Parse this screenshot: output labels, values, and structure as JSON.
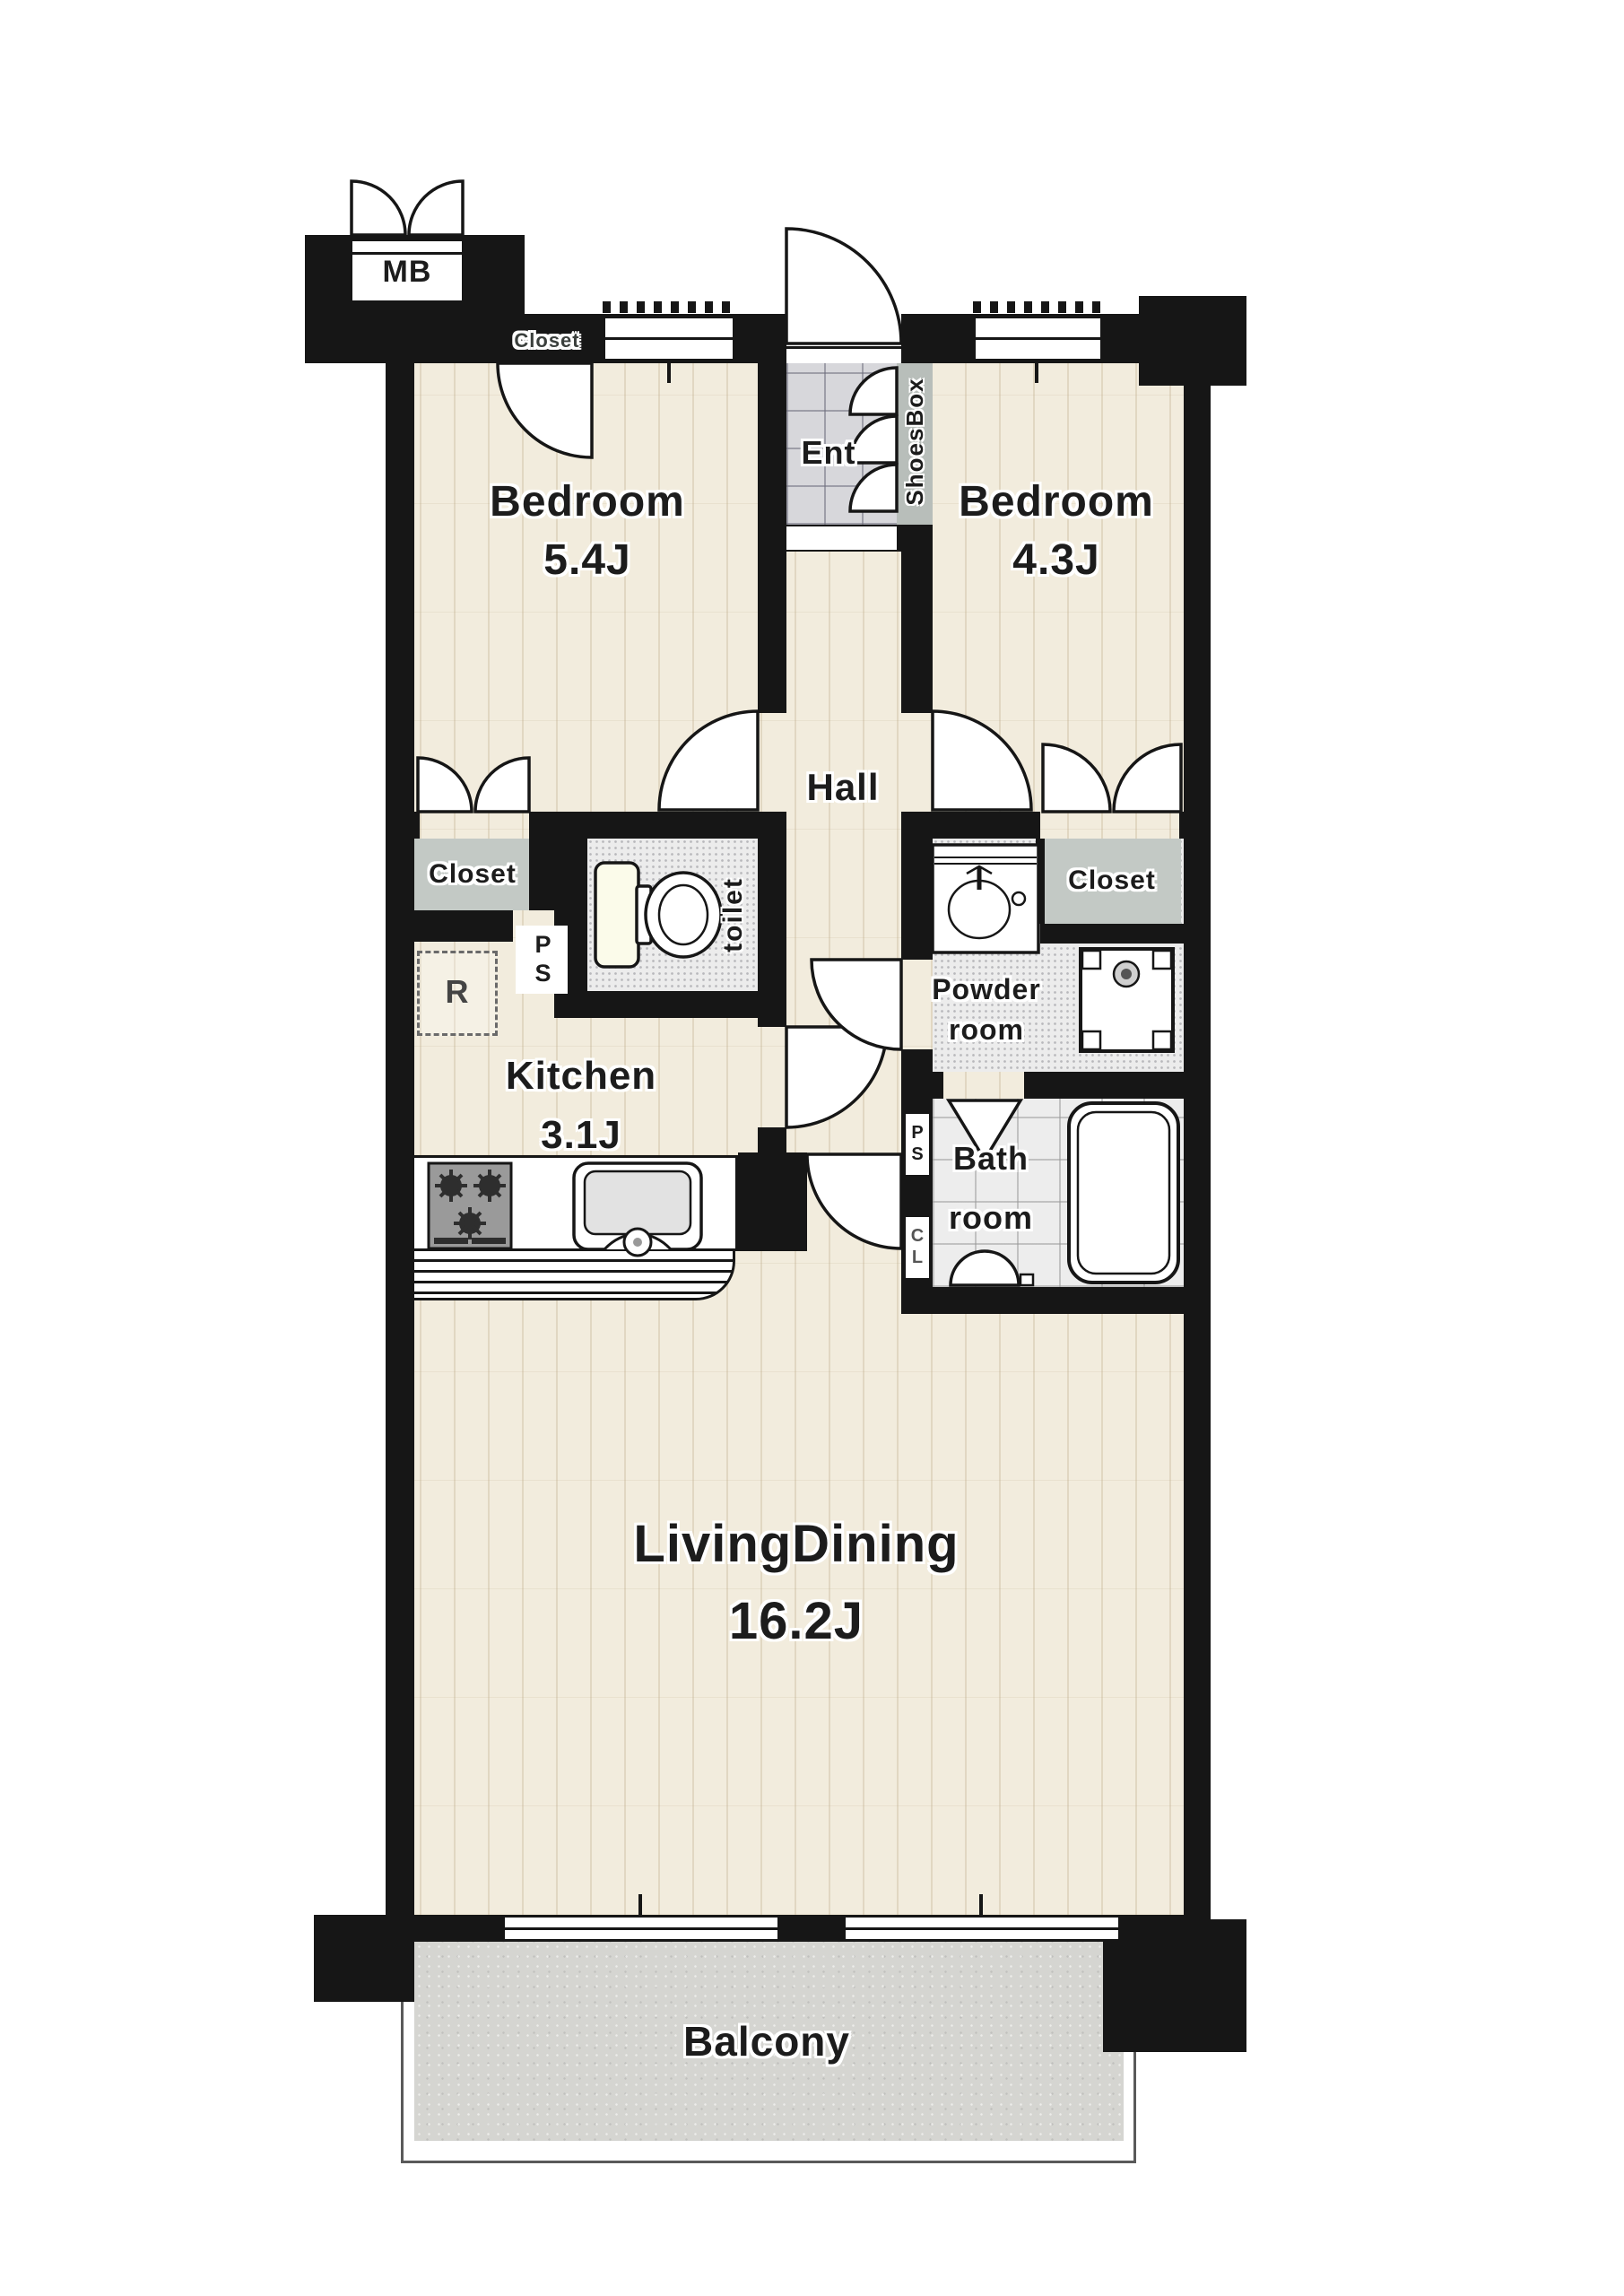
{
  "title": "2LDK apartment floor plan",
  "rooms": {
    "bedroom_left": {
      "name": "Bedroom",
      "size": "5.4J"
    },
    "bedroom_right": {
      "name": "Bedroom",
      "size": "4.3J"
    },
    "living_dining": {
      "name": "LivingDining",
      "size": "16.2J"
    },
    "kitchen": {
      "name": "Kitchen",
      "size": "3.1J"
    },
    "hall": {
      "name": "Hall"
    },
    "entrance": {
      "name": "Ent"
    },
    "toilet": {
      "name": "toilet"
    },
    "powder_room": {
      "line1": "Powder",
      "line2": "room"
    },
    "bathroom": {
      "line1": "Bath",
      "line2": "room"
    },
    "balcony": {
      "name": "Balcony"
    }
  },
  "storage": {
    "meter_box": "MB",
    "closet_top": "Closet",
    "closet_bedroom_left": "Closet",
    "closet_bedroom_right": "Closet",
    "shoes_box": "ShoesBox",
    "refrigerator_space": "R",
    "pipe_shaft_kitchen": "PS",
    "pipe_shaft_bath": "PS",
    "closet_niche_bath": "CL"
  },
  "colors": {
    "wall": "#161616",
    "wood": "#f2ecdd",
    "wood_grain": "#baa684",
    "tile": "#d7d7db",
    "shoesbox": "#b8beba",
    "closet": "#c3c9c5",
    "wet_floor": "#ececec",
    "bath_floor": "#ededed",
    "balcony": "#d5d5d1",
    "stove": "#9a9a9a",
    "text": "#1c1c1c"
  }
}
